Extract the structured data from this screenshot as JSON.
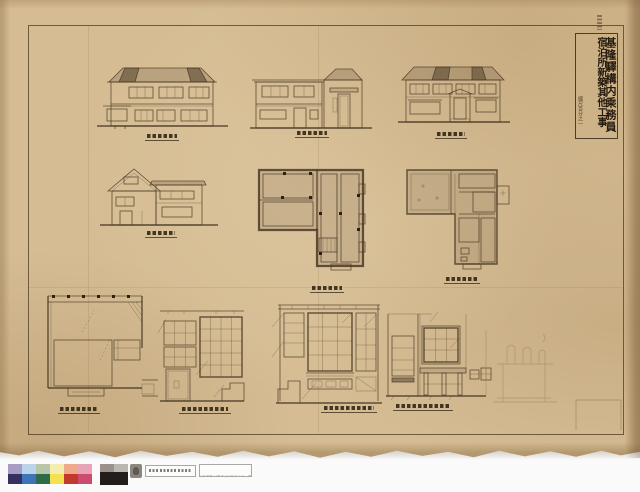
{
  "document": {
    "title_right_column": "基隆驛構内乘務員",
    "title_left_column": "宿泊所新築其他工事",
    "scale_note": "縮尺百分之一"
  },
  "drawings": {
    "row1": [
      "front-elevation",
      "side-elevation",
      "rear-elevation"
    ],
    "row2": [
      "gable-end-elevation",
      "first-floor-plan",
      "second-floor-plan"
    ],
    "row3": [
      "bath-detail-plan",
      "interior-elevation-a",
      "interior-elevation-b",
      "interior-elevation-c",
      "pencil-furniture-sketch"
    ]
  },
  "footer": {
    "project_label": "基隆驛構内乘務員宿泊所新築其他工事",
    "swatches_top": [
      "#a89cc6",
      "#bad5ea",
      "#b8c5a8",
      "#f3eeae",
      "#eeaa8b",
      "#e9a3b6"
    ],
    "swatches_bottom": [
      "#34305f",
      "#3f73ba",
      "#2f6b47",
      "#f5e04f",
      "#c23a2c",
      "#ca4d70"
    ],
    "grays": [
      "#9c918a",
      "#bab6b1"
    ],
    "black": "#211d1a"
  },
  "colors": {
    "paper": "#d5bc93",
    "ink": "#4a3a26"
  }
}
